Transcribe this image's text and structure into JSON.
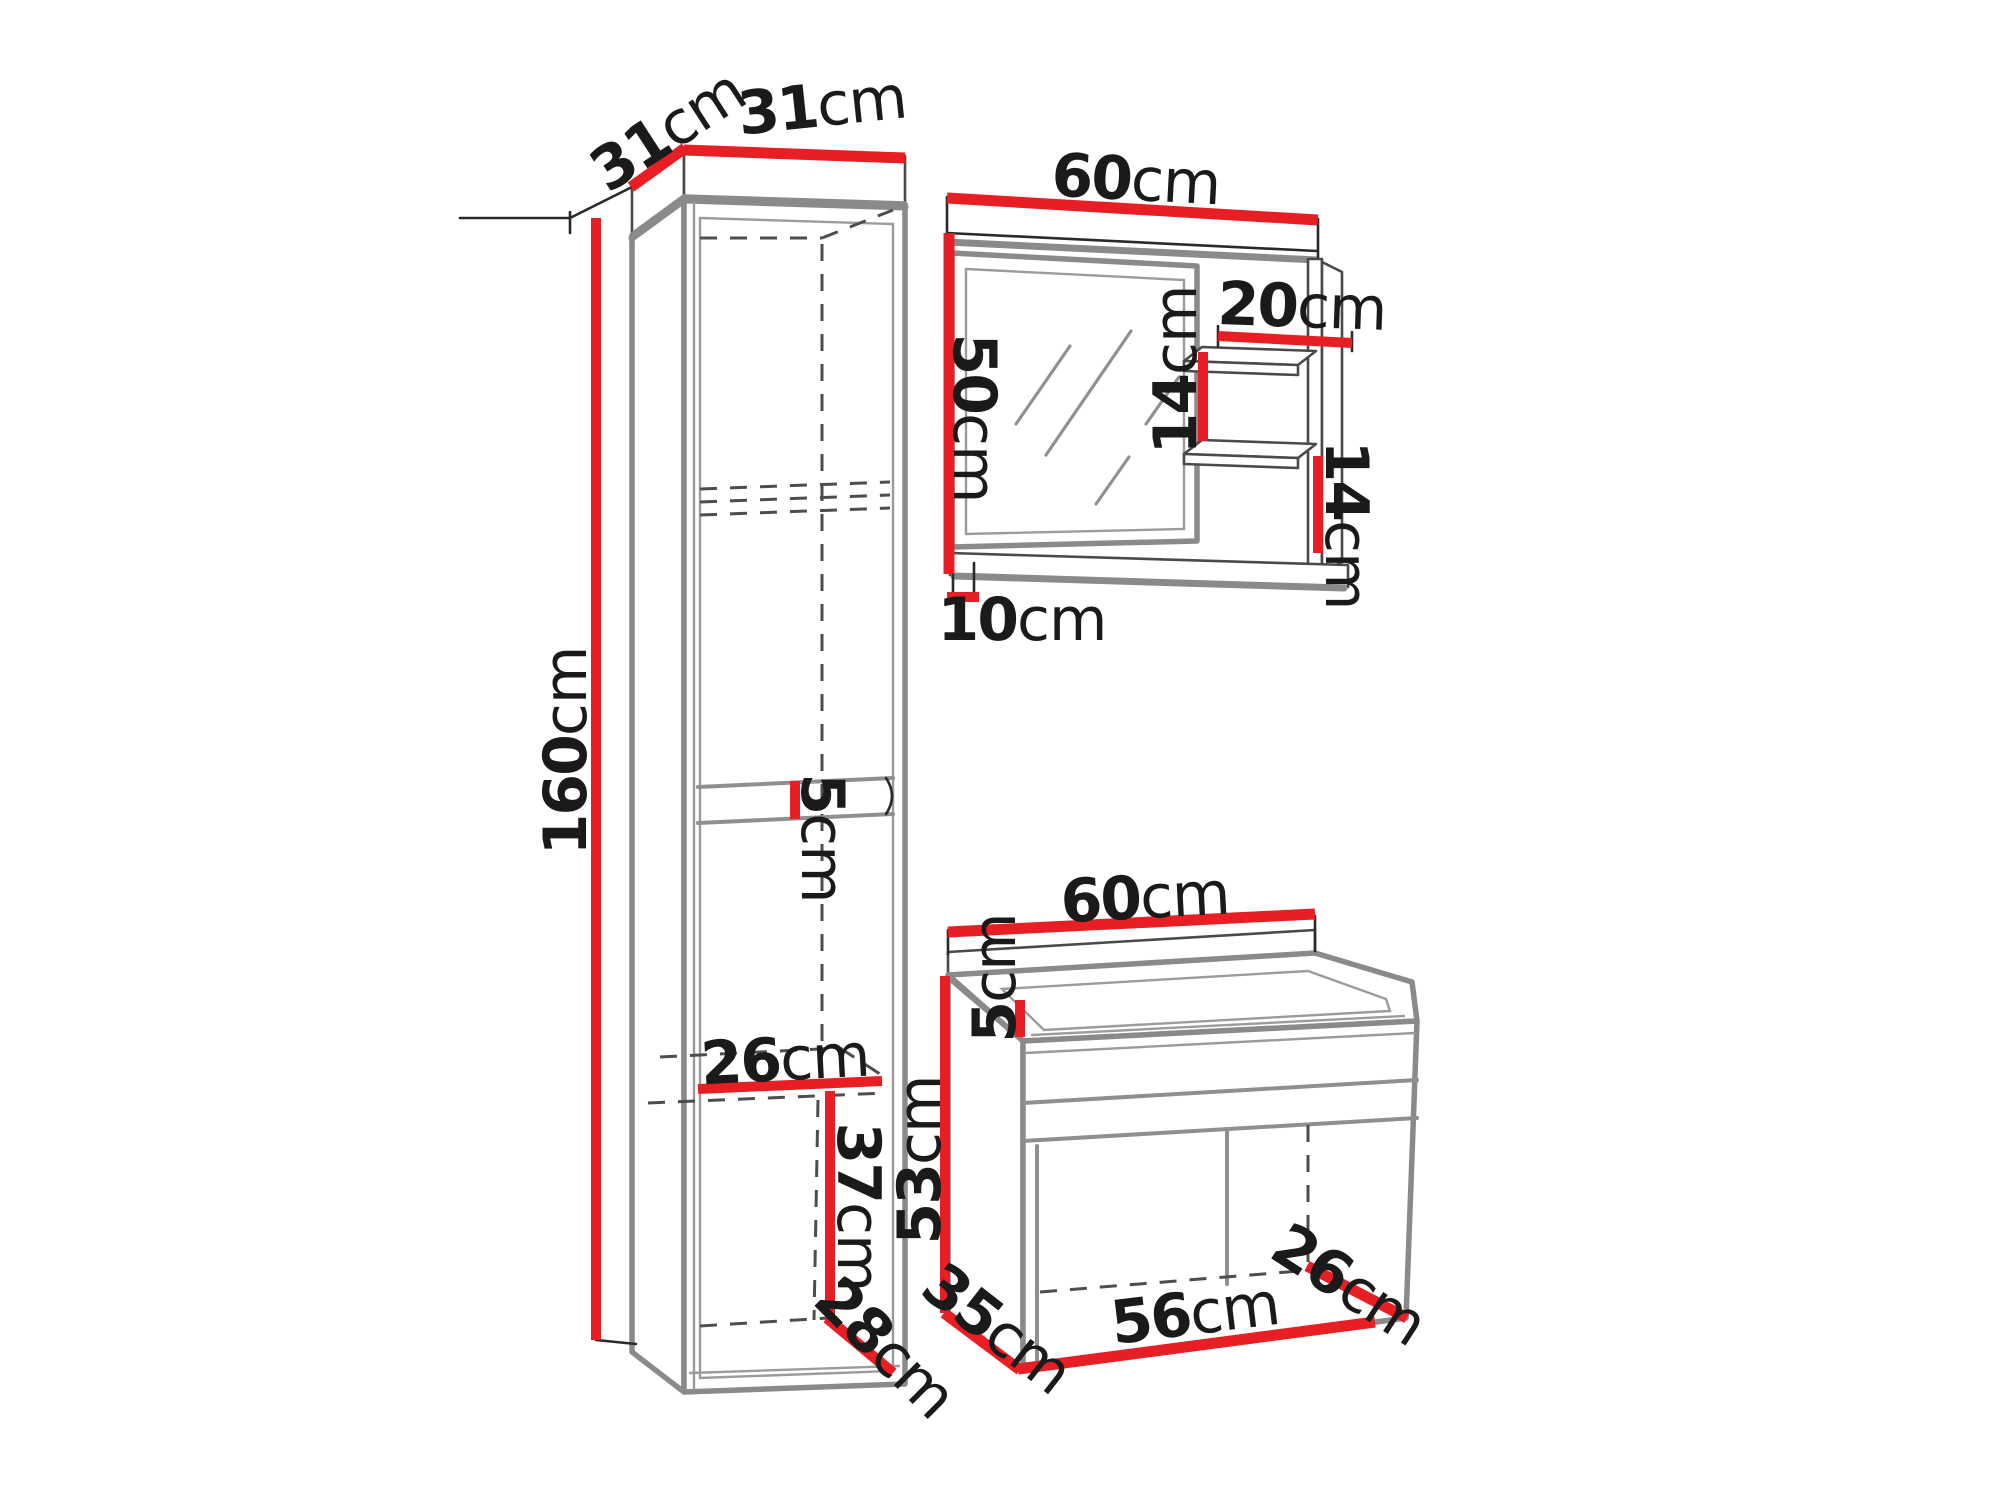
{
  "diagram_type": "furniture-dimension-drawing",
  "colors": {
    "dimension_line": "#e81e25",
    "outline": "#8a8a8a",
    "thin_line": "#2a2a2a",
    "text": "#1a1a1a",
    "background": "#ffffff"
  },
  "pieces": {
    "tall_cabinet": "tall storage cabinet (left)",
    "mirror_unit": "wall mirror with side shelves (top right)",
    "vanity": "washbasin cabinet (bottom right)"
  },
  "dims": {
    "cabinet_depth": {
      "value": "31",
      "unit": "cm"
    },
    "cabinet_width": {
      "value": "31",
      "unit": "cm"
    },
    "cabinet_height": {
      "value": "160",
      "unit": "cm"
    },
    "cabinet_shelf": {
      "value": "5",
      "unit": "cm"
    },
    "cabinet_inner_width": {
      "value": "26",
      "unit": "cm"
    },
    "cabinet_lower_height": {
      "value": "37",
      "unit": "cm"
    },
    "cabinet_lower_depth": {
      "value": "28",
      "unit": "cm"
    },
    "mirror_width": {
      "value": "60",
      "unit": "cm"
    },
    "mirror_height": {
      "value": "50",
      "unit": "cm"
    },
    "shelf_width": {
      "value": "20",
      "unit": "cm"
    },
    "shelf_spacing": {
      "value": "14",
      "unit": "cm"
    },
    "shelf_side_height": {
      "value": "14",
      "unit": "cm"
    },
    "mirror_shelf_depth": {
      "value": "10",
      "unit": "cm"
    },
    "vanity_width": {
      "value": "60",
      "unit": "cm"
    },
    "vanity_splash_height": {
      "value": "5",
      "unit": "cm"
    },
    "vanity_height": {
      "value": "53",
      "unit": "cm"
    },
    "vanity_depth": {
      "value": "35",
      "unit": "cm"
    },
    "vanity_inner_width": {
      "value": "56",
      "unit": "cm"
    },
    "vanity_inner_depth": {
      "value": "26",
      "unit": "cm"
    }
  }
}
